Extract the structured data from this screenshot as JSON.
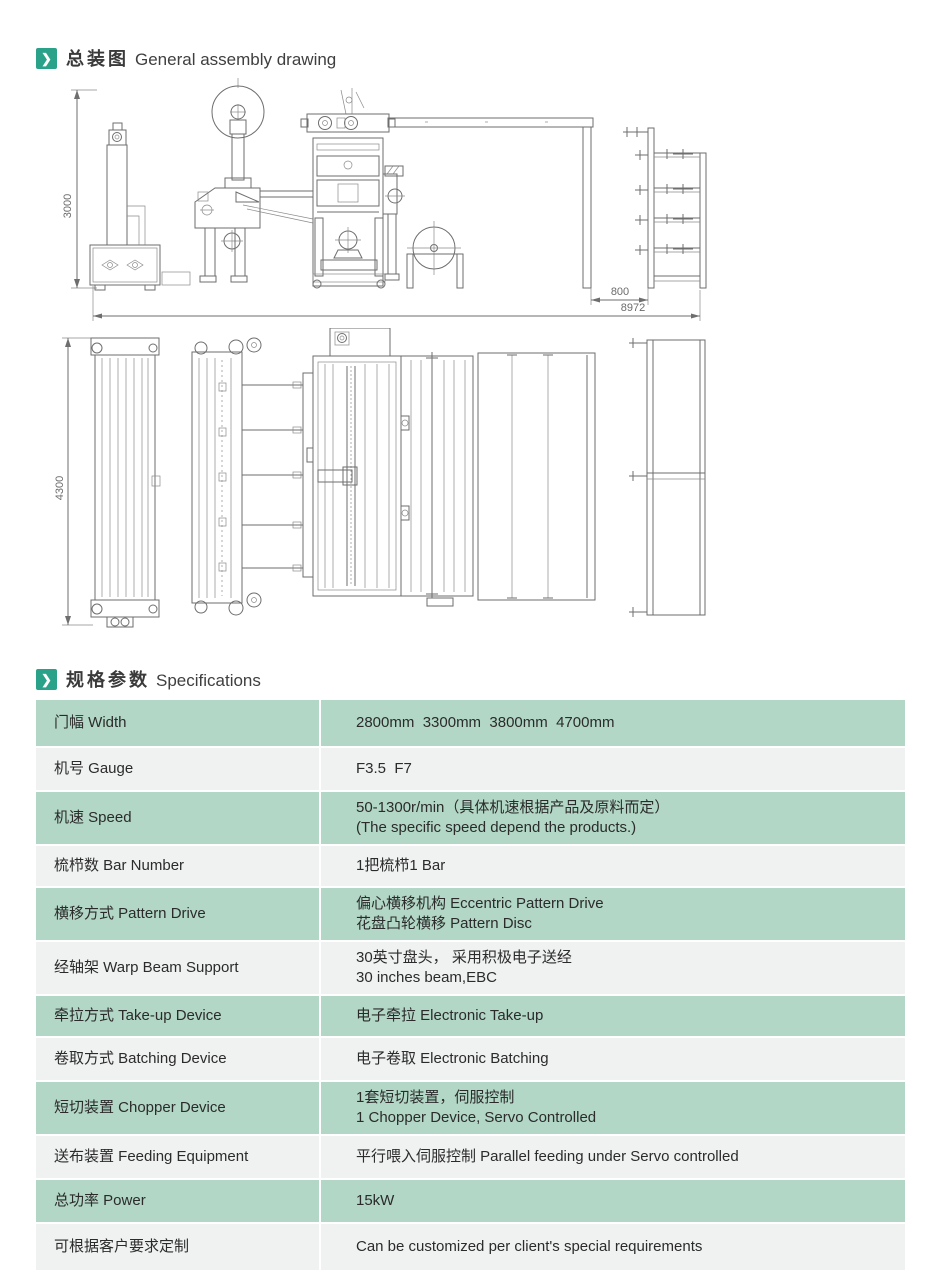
{
  "colors": {
    "accent_teal": "#2aa289",
    "row_green": "#b2d7c6",
    "row_gray": "#f0f1f1",
    "text_dark": "#2b2b2b"
  },
  "sections": {
    "assembly": {
      "title_zh": "总装图",
      "title_en": "General assembly drawing"
    },
    "specs": {
      "title_zh": "规格参数",
      "title_en": "Specifications"
    }
  },
  "drawing": {
    "dim_height": "3000",
    "dim_total_length": "8972",
    "dim_creel_gap": "800",
    "dim_plan_width": "4300"
  },
  "spec_table": {
    "rows": [
      {
        "label": "门幅 Width",
        "value_lines": [
          "2800mm  3300mm  3800mm  4700mm"
        ]
      },
      {
        "label": "机号 Gauge",
        "value_lines": [
          "F3.5  F7"
        ]
      },
      {
        "label": "机速 Speed",
        "value_lines": [
          "50-1300r/min（具体机速根据产品及原料而定）",
          "(The specific speed depend the products.)"
        ]
      },
      {
        "label": "梳栉数 Bar Number",
        "value_lines": [
          "1把梳栉1 Bar"
        ]
      },
      {
        "label": "横移方式 Pattern Drive",
        "value_lines": [
          "偏心横移机构 Eccentric Pattern Drive",
          "花盘凸轮横移 Pattern Disc"
        ]
      },
      {
        "label": "经轴架 Warp Beam Support",
        "value_lines": [
          "30英寸盘头， 采用积极电子送经",
          "30 inches beam,EBC"
        ]
      },
      {
        "label": "牵拉方式 Take-up Device",
        "value_lines": [
          "电子牵拉 Electronic Take-up"
        ]
      },
      {
        "label": "卷取方式 Batching Device",
        "value_lines": [
          "电子卷取 Electronic Batching"
        ]
      },
      {
        "label": "短切装置 Chopper Device",
        "value_lines": [
          "1套短切装置，伺服控制",
          "1 Chopper Device, Servo Controlled"
        ]
      },
      {
        "label": "送布装置 Feeding Equipment",
        "value_lines": [
          "平行喂入伺服控制 Parallel feeding under Servo controlled"
        ]
      },
      {
        "label": "总功率 Power",
        "value_lines": [
          "15kW"
        ]
      },
      {
        "label": "可根据客户要求定制",
        "value_lines": [
          "Can be customized per client's special requirements"
        ]
      }
    ]
  }
}
